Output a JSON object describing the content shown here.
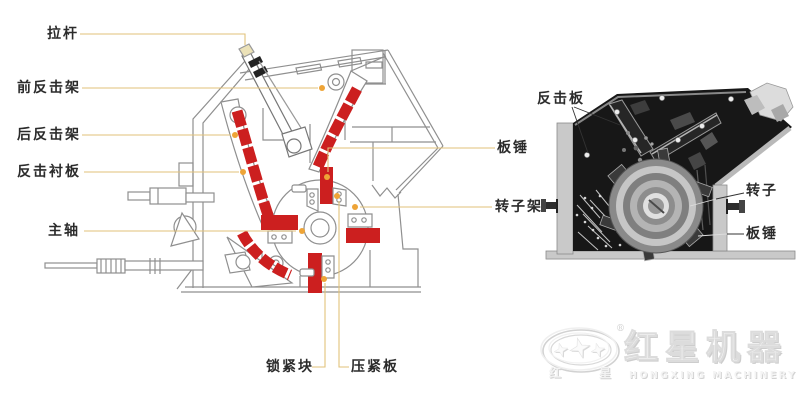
{
  "figure": {
    "description_type": "impact-crusher-structure-diagram"
  },
  "left_diagram": {
    "labels": {
      "tie_rod": "拉杆",
      "front_impact_frame": "前反击架",
      "rear_impact_frame": "后反击架",
      "impact_liner_plate": "反击衬板",
      "main_shaft": "主轴",
      "blow_bar": "板锤",
      "rotor_frame": "转子架",
      "locking_block": "锁紧块",
      "pressing_plate": "压紧板"
    }
  },
  "right_diagram": {
    "labels": {
      "impact_plate": "反击板",
      "rotor": "转子",
      "blow_bar": "板锤"
    }
  },
  "logo": {
    "registered_mark": "®",
    "seal_char_left": "红",
    "seal_char_right": "星",
    "brand_zh": "红星机器",
    "brand_en": "HONGXING MACHINERY"
  },
  "colors": {
    "highlight_red": "#cc1f1f",
    "callout_line": "#e2c27a",
    "callout_dot": "#eea437",
    "schematic_line": "#8f8f8f",
    "label_text": "#2b2b2b",
    "photo_dark": "#171717"
  }
}
